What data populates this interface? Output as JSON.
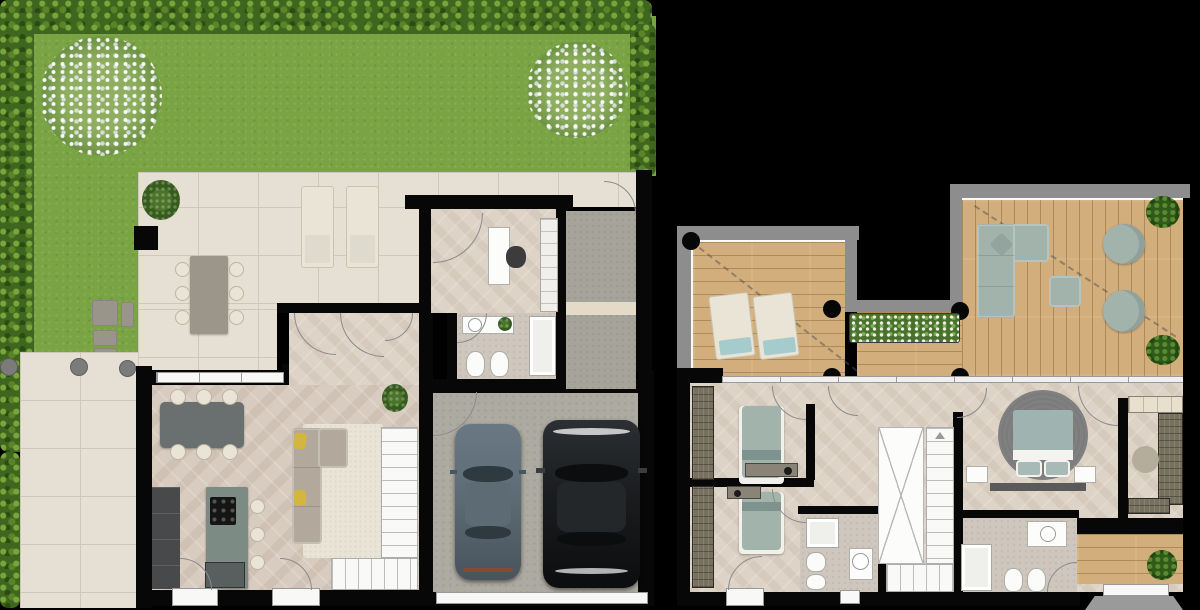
{
  "canvas": {
    "width": 1200,
    "height": 610,
    "background": "#000000"
  },
  "scene": {
    "type": "real-estate floor plan rendering, top-down 2D view, two plans side by side on black background, no text labels",
    "plans": [
      {
        "name": "ground-floor-with-garden",
        "position": "left",
        "outdoor": {
          "garden": {
            "lawn": true,
            "hedge_sides": [
              "top",
              "left",
              "right"
            ],
            "flowering_shrubs": 2,
            "stepping_stones": 4,
            "bollards": 3,
            "paved_walkway": "left edge"
          },
          "patio": {
            "outdoor_dining_table_seats": 6,
            "sun_loungers": 2,
            "potted_plants": 1,
            "column": 1
          },
          "entry_path": {
            "material": "concrete",
            "entrance_door": true,
            "doorstep": true
          }
        },
        "rooms": [
          {
            "name": "living-dining-kitchen",
            "furniture": [
              "dining table with 6 chairs",
              "kitchen wall cabinets",
              "kitchen island with cooktop",
              "3 bar stools",
              "L-shaped sofa with 2 yellow cushions",
              "area rug",
              "L-shaped staircase",
              "potted plant",
              "2 french doors to front"
            ]
          },
          {
            "name": "hallway",
            "furniture": [
              "3 doors",
              "potted plant"
            ]
          },
          {
            "name": "study",
            "furniture": [
              "desk",
              "office chair",
              "shelving unit"
            ]
          },
          {
            "name": "bathroom",
            "furniture": [
              "vanity with round sink",
              "small plant",
              "toilet",
              "bidet",
              "shower"
            ]
          },
          {
            "name": "garage",
            "furniture": [
              "gray car",
              "black car",
              "wide garage door"
            ]
          }
        ]
      },
      {
        "name": "first-floor",
        "position": "right",
        "outdoor": {
          "terrace": {
            "deck": "wood planks",
            "parapet": "gray with white inner edge",
            "round_columns": 5,
            "sun_loungers_with_teal_towels": 2,
            "outdoor_L_sofa": 1,
            "ottoman": 1,
            "round_armchairs": 2,
            "round_bushes": 2,
            "flower_planter": 1,
            "roof_overhang_dashed_lines": 2,
            "void_cutout": "U-shaped notch at top middle"
          },
          "balcony": {
            "position": "bottom right",
            "deck": "wood",
            "plant": 1,
            "awning_below": true
          }
        },
        "rooms": [
          {
            "name": "bedroom-1",
            "furniture": [
              "single bed",
              "tall wardrobe",
              "bench with lamp"
            ]
          },
          {
            "name": "bedroom-2",
            "furniture": [
              "single bed",
              "tall wardrobe",
              "bench with lamp",
              "door to front"
            ]
          },
          {
            "name": "bathroom-1",
            "furniture": [
              "shower",
              "toilet",
              "bidet",
              "round sink"
            ]
          },
          {
            "name": "hallway-landing",
            "furniture": [
              "doors"
            ]
          },
          {
            "name": "staircase",
            "furniture": [
              "open void marked with X",
              "straight flight",
              "bottom flight",
              "direction arrow"
            ]
          },
          {
            "name": "master-bedroom",
            "furniture": [
              "double bed with 2 pillows",
              "round dark rug",
              "2 nightstands",
              "headboard bench"
            ]
          },
          {
            "name": "walk-in-closet",
            "furniture": [
              "wardrobes on three sides",
              "round pouf"
            ]
          },
          {
            "name": "bathroom-2",
            "furniture": [
              "shower",
              "toilet",
              "bidet",
              "vanity with round sink"
            ]
          }
        ]
      }
    ]
  },
  "colors": {
    "grass": "#7aa443",
    "hedge-dark": "#3f661e",
    "hedge-light": "#79a63c",
    "tile": "#e6e0d4",
    "tile-line": "#cfc7b8",
    "wood": "#d8ccc0",
    "wood-light": "#ddd3c7",
    "stone": "#cfc7bd",
    "concrete": "#adaaa1",
    "path": "#a6a39a",
    "deck": "#d3ae7d",
    "wall": "#070707",
    "parapet": "#8d8d8d",
    "cream": "#e9e4d6",
    "sofa": "#b2a99c",
    "sage": "#a2b3ac",
    "teal": "#a5cbcd",
    "yellow": "#d2b63e",
    "rug": "#eae4d6",
    "rug-dark": "#808080",
    "island": "#7d8b85",
    "cabinet": "#47494a",
    "table-dark": "#69706f",
    "table-stone": "#9b958a",
    "ward": "#77705f",
    "step": "#e4dac8",
    "car-gray": "#5f6e78",
    "car-black": "#1a1c1e"
  }
}
